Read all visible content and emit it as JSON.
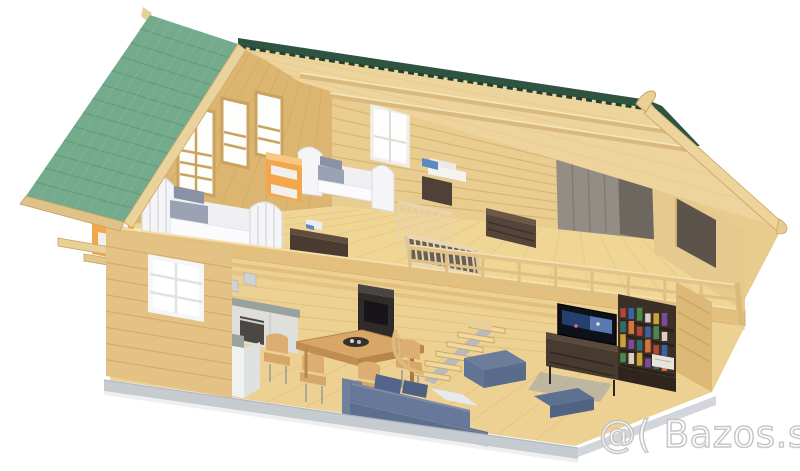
{
  "meta": {
    "type": "3d-render",
    "subject": "Isometric cutaway 3D rendering of a two-storey wooden log cabin with a green tiled gable roof",
    "background": "#ffffff"
  },
  "watermark": {
    "text": "@( Bazos.sk",
    "fill": "#ffffff",
    "outline": "#c3c3c3"
  },
  "palette": {
    "roof_green": "#74ab8d",
    "roof_green_rows": "#639a7c",
    "roof_green_cols": "#86b89c",
    "ridge_green_dark": "#2e5340",
    "wood_light": "#edd49c",
    "wood_mid": "#e4c285",
    "wood_floor": "#f0d695",
    "wood_dark_line": "#c9a25f",
    "panel_gray": "#948d85",
    "panel_gray_dark": "#6e6760",
    "sofa_blue": "#67789a",
    "sofa_blue_dark": "#5d6f8f",
    "accent_orange": "#f3a74d",
    "furniture_brown": "#47392e",
    "counter_gray": "#9aa2a2",
    "cabinet_white": "#f0f1f1",
    "foundation_gray": "#c6cbd0",
    "books": [
      "#b5443a",
      "#3a62a8",
      "#4a8a4f",
      "#d8d0c0",
      "#caa23c",
      "#7a4a9c",
      "#2f6f6a",
      "#d4763b"
    ]
  },
  "scene": {
    "attic": {
      "label": "attic bedrooms",
      "objects": [
        "single bed x2",
        "orange nightstand x2",
        "linen cabinet with towels",
        "chest of drawers",
        "baby crib",
        "TV bench with toy",
        "grey TV wall panel",
        "balcony with wooden railing"
      ]
    },
    "ground_floor": {
      "label": "open-plan ground floor",
      "objects": [
        "kitchen island with sink",
        "kitchen counter with oven and pots",
        "white framed window",
        "dining table with bowl and four chairs",
        "wood stove",
        "open wooden staircase",
        "corner sofa with cushions",
        "pouf and floor cushion",
        "TV on dark media console",
        "bookshelf full of books"
      ]
    }
  }
}
